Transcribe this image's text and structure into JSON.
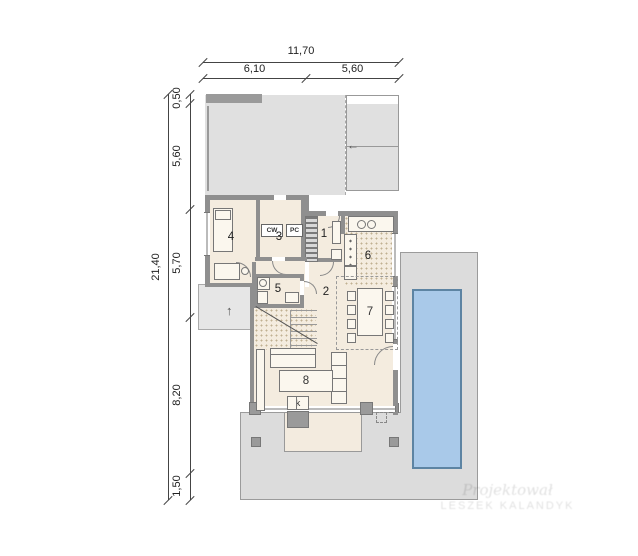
{
  "dims": {
    "top_total": "11,70",
    "top_seg1": "6,10",
    "top_seg2": "5,60",
    "left_total": "21,40",
    "left_segs": [
      "0,50",
      "5,60",
      "5,70",
      "8,20",
      "1,50"
    ]
  },
  "rooms": {
    "r1": "1",
    "r2": "2",
    "r3": "3",
    "r4": "4",
    "r5": "5",
    "r6": "6",
    "r7": "7",
    "r8": "8"
  },
  "labels": {
    "cw": "CW",
    "pc": "PC",
    "fireplace": "k"
  },
  "icons": {
    "entry_arrow_up": "↑",
    "driveway_arrow_left": "←"
  },
  "watermark": {
    "line1": "Projektował",
    "line2": "LESZEK KALANDYK"
  },
  "colors": {
    "wall": "#8f8f8f",
    "floor": "#f4ecdf",
    "terrace": "#dcdcdc",
    "garage_floor": "#e0e0e0",
    "pool": "#a9c9e9",
    "pool_border": "#5d84a3",
    "dim_line": "#444444"
  }
}
